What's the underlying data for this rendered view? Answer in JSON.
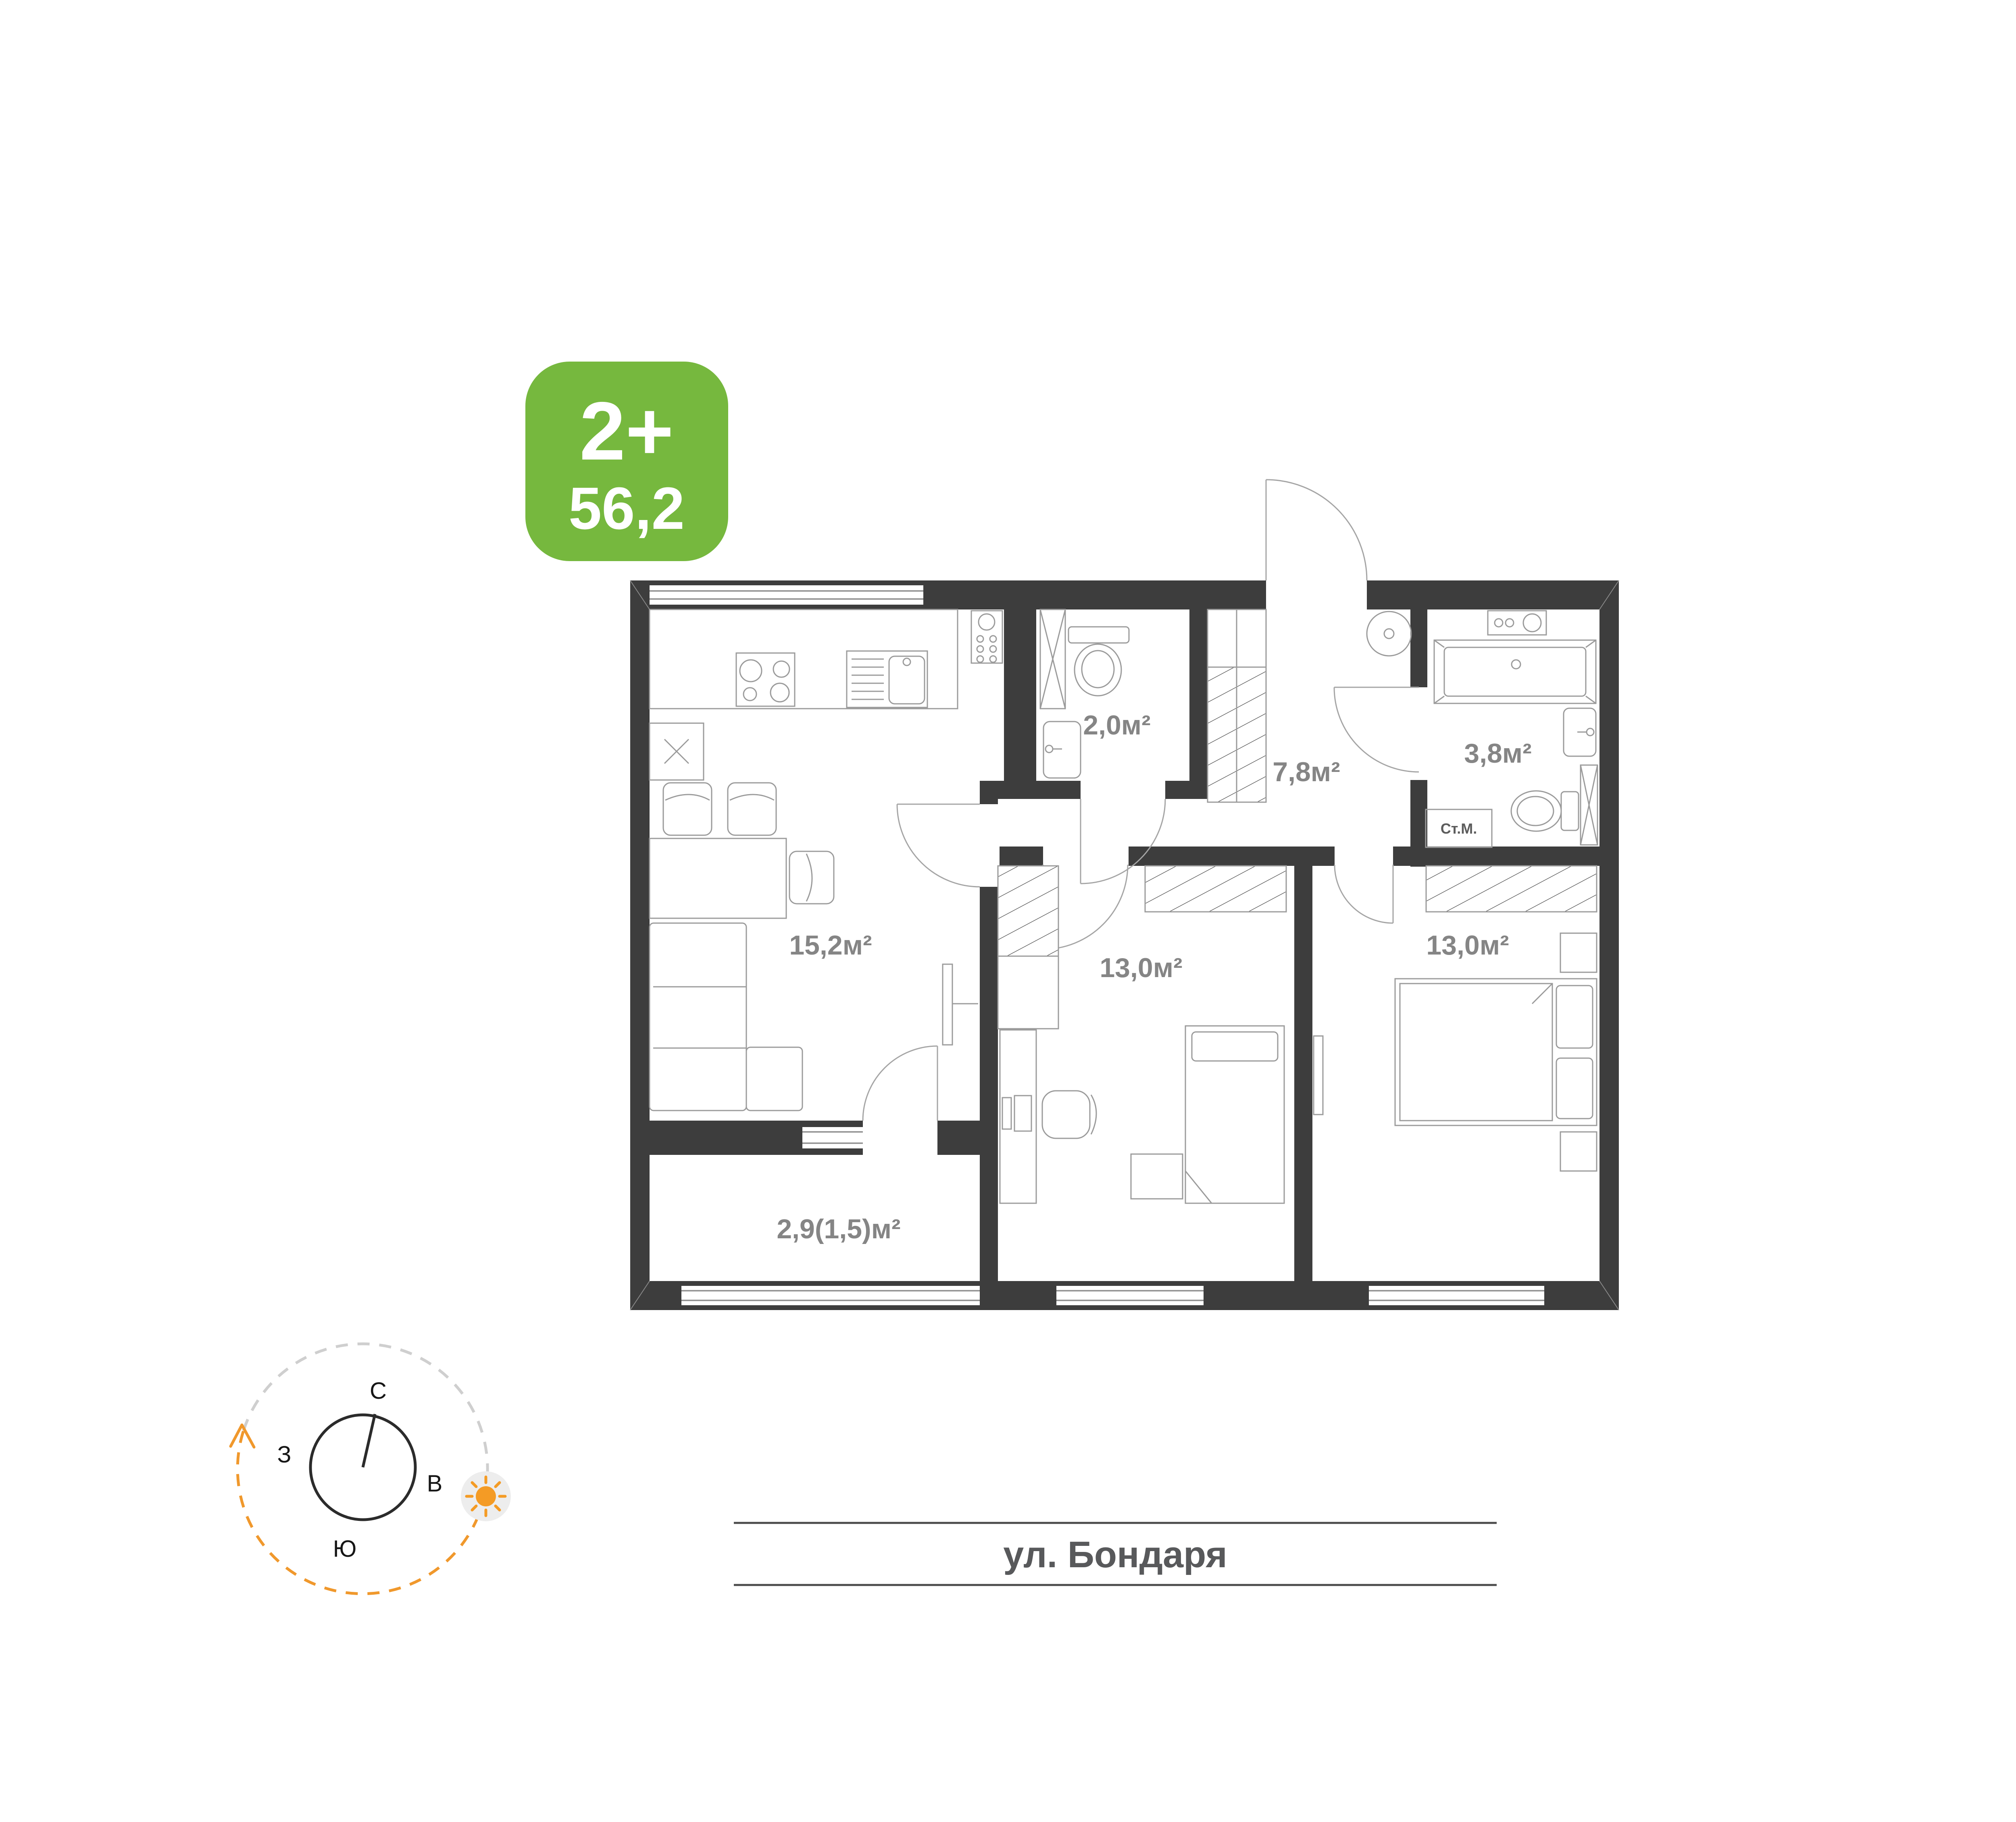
{
  "badge": {
    "rooms": "2+",
    "area": "56,2"
  },
  "plan": {
    "rooms": [
      {
        "id": "kitchen-living",
        "label": "15,2м²"
      },
      {
        "id": "toilet",
        "label": "2,0м²"
      },
      {
        "id": "bathroom",
        "label": "3,8м²"
      },
      {
        "id": "hallway",
        "label": "7,8м²"
      },
      {
        "id": "bedroom-center",
        "label": "13,0м²"
      },
      {
        "id": "bedroom-right",
        "label": "13,0м²"
      },
      {
        "id": "balcony",
        "label": "2,9(1,5)м²"
      }
    ],
    "washing_machine_label": "Ст.М."
  },
  "streets": {
    "right": "ул. Воронежская",
    "bottom": "ул. Бондаря"
  },
  "compass": {
    "north": "С",
    "east": "В",
    "south": "Ю",
    "west": "З"
  },
  "colors": {
    "badge_green": "#76b83e",
    "walls": "#3d3d3d",
    "room_labels": "#858585",
    "street_text": "#58595b",
    "compass_orange": "#f0982c"
  }
}
